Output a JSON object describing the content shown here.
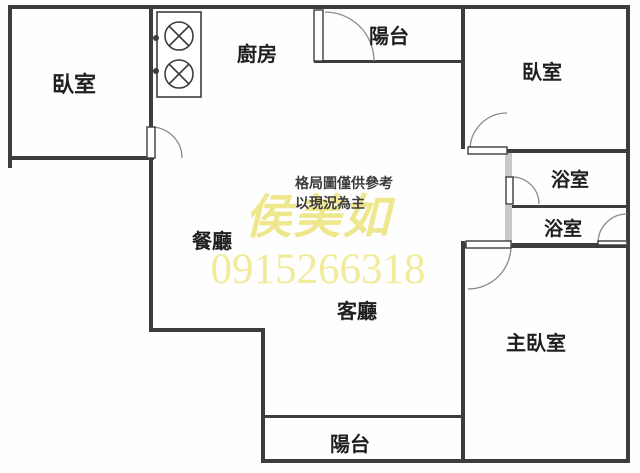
{
  "floorplan": {
    "type": "apartment-floor-plan",
    "rooms": {
      "bedroom_left": "臥室",
      "kitchen": "廚房",
      "balcony_top": "陽台",
      "bedroom_right": "臥室",
      "bath_upper": "浴室",
      "bath_lower": "浴室",
      "dining": "餐廳",
      "living": "客廳",
      "master_bedroom": "主臥室",
      "balcony_bottom": "陽台"
    },
    "disclaimer": {
      "line1": "格局圖僅供參考",
      "line2": "以現況為主"
    },
    "watermark": {
      "name": "侯美如",
      "phone": "0915266318"
    },
    "colors": {
      "wall": "#3d3d3d",
      "light_wall": "#c9c9c9",
      "watermark_yellow": "#f0e98f",
      "background": "#fefefe"
    }
  }
}
